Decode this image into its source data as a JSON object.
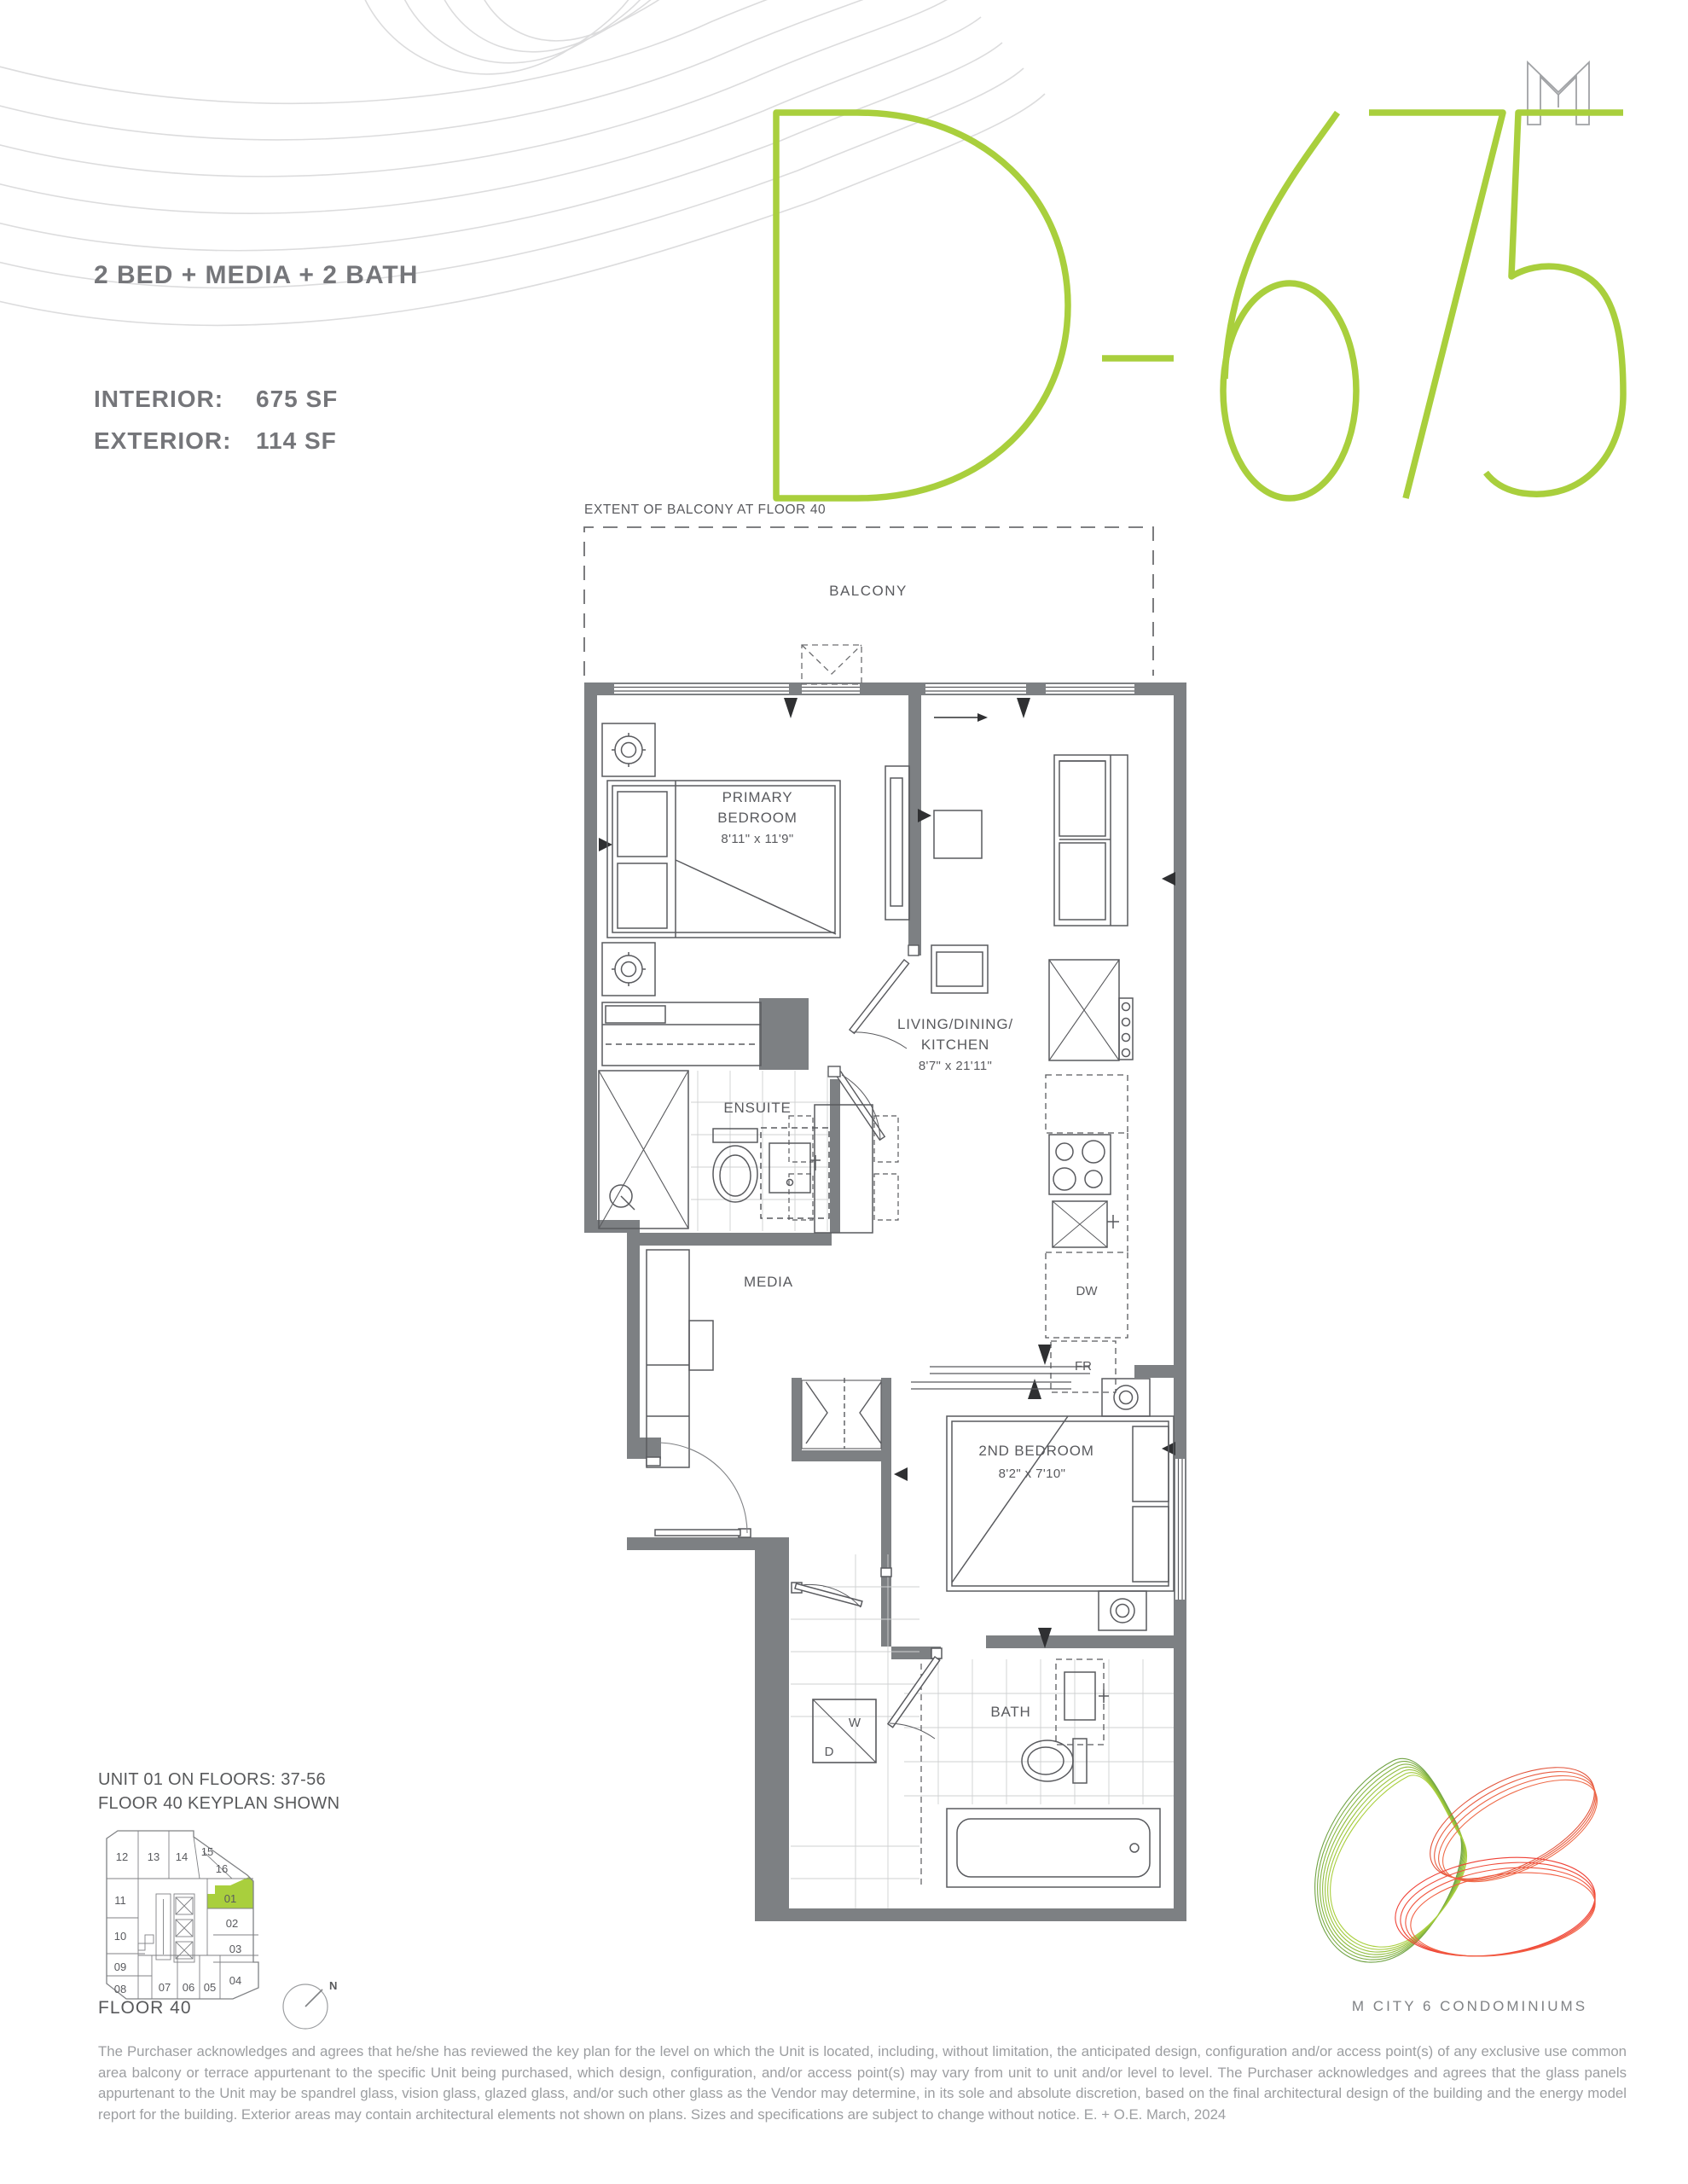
{
  "header": {
    "spec": "2 BED + MEDIA + 2 BATH",
    "interior_label": "INTERIOR:",
    "interior_value": "675 SF",
    "exterior_label": "EXTERIOR:",
    "exterior_value": "114 SF",
    "unit_code": "D-675"
  },
  "plan": {
    "extent_label": "EXTENT OF BALCONY AT FLOOR 40",
    "balcony": "BALCONY",
    "primary_bedroom_l1": "PRIMARY",
    "primary_bedroom_l2": "BEDROOM",
    "primary_bedroom_dims": "8'11\" x 11'9\"",
    "living_l1": "LIVING/DINING/",
    "living_l2": "KITCHEN",
    "living_dims": "8'7\" x 21'11\"",
    "ensuite": "ENSUITE",
    "media": "MEDIA",
    "second_bedroom": "2ND BEDROOM",
    "second_bedroom_dims": "8'2\" x 7'10\"",
    "bath": "BATH",
    "dishwasher": "DW",
    "fridge": "FR",
    "washer": "W",
    "dryer": "D"
  },
  "keyplan": {
    "line1": "UNIT 01 ON FLOORS: 37-56",
    "line2": "FLOOR 40 KEYPLAN SHOWN",
    "floor": "FLOOR 40",
    "north": "N",
    "highlighted_unit": "01",
    "units": {
      "u01": "01",
      "u02": "02",
      "u03": "03",
      "u04": "04",
      "u05": "05",
      "u06": "06",
      "u07": "07",
      "u08": "08",
      "u09": "09",
      "u10": "10",
      "u11": "11",
      "u12": "12",
      "u13": "13",
      "u14": "14",
      "u15": "15",
      "u16": "16"
    }
  },
  "footer": {
    "brand": "M CITY 6 CONDOMINIUMS",
    "disclaimer": "The Purchaser acknowledges and agrees that he/she has reviewed the key plan for the level on which the Unit is located, including, without limitation, the anticipated design, configuration and/or access point(s) of any exclusive use common area balcony or terrace appurtenant to the specific Unit being purchased, which design, configuration, and/or access point(s) may vary from unit to unit and/or level to level. The Purchaser acknowledges and agrees that the glass panels appurtenant to the Unit may be spandrel glass, vision glass, glazed glass, and/or such other glass as the Vendor may determine, in its sole and absolute discretion, based on the final architectural design of the building and the energy model report for the building. Exterior areas may contain architectural elements not shown on plans. Sizes and specifications are subject to change without notice. E. + O.E. March, 2024"
  },
  "colors": {
    "accent_green": "#A9CF3D",
    "wall_gray": "#7D8083",
    "ink_gray": "#595A5E",
    "muted_gray": "#75767A",
    "faint_gray": "#9C9EA1"
  }
}
